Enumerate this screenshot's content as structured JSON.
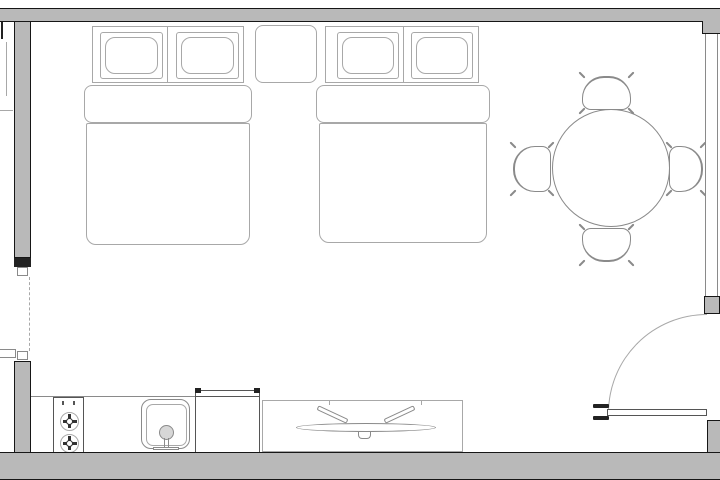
{
  "meta": {
    "title": "studio-room-floor-plan"
  },
  "canvas": {
    "w": 720,
    "h": 480,
    "bg": "#ffffff"
  },
  "colors": {
    "wall_fill": "#b9b9b9",
    "wall_edge": "#161616",
    "mark": "#222222",
    "line_dark": "#555555",
    "line_mid": "#8a8a8a",
    "line_light": "#a8a8a8",
    "fixture": "#d7d7d7",
    "white": "#ffffff"
  },
  "architecture": [
    {
      "name": "top-wall",
      "kind": "wall",
      "box": [
        0,
        8,
        720,
        14
      ],
      "edges": "tb"
    },
    {
      "name": "top-right-corner-wall",
      "kind": "wall",
      "box": [
        702,
        21,
        18,
        13
      ],
      "edges": "lb"
    },
    {
      "name": "left-wall-upper",
      "kind": "wall",
      "box": [
        14,
        21,
        17,
        237
      ],
      "edges": "all"
    },
    {
      "name": "left-wall-end-cap",
      "kind": "block",
      "box": [
        14,
        258,
        17,
        9
      ],
      "color": "mark"
    },
    {
      "name": "left-doorway-jamb-upper",
      "kind": "jamb",
      "box": [
        17,
        267,
        11,
        9
      ]
    },
    {
      "name": "left-doorway-dashed-line",
      "kind": "vdash",
      "box": [
        29,
        277,
        1,
        74
      ]
    },
    {
      "name": "left-doorway-jamb-lower",
      "kind": "jamb",
      "box": [
        17,
        351,
        11,
        9
      ]
    },
    {
      "name": "left-wall-lower",
      "kind": "wall",
      "box": [
        14,
        361,
        17,
        95
      ],
      "edges": "all"
    },
    {
      "name": "right-window",
      "kind": "window",
      "box": [
        705,
        34,
        13,
        262
      ]
    },
    {
      "name": "door-side-pier",
      "kind": "wall",
      "box": [
        704,
        296,
        16,
        18
      ],
      "edges": "all"
    },
    {
      "name": "door-swing-arc",
      "kind": "doorarc",
      "box": [
        608,
        314,
        99,
        99
      ]
    },
    {
      "name": "door-leaf",
      "kind": "doorleaf",
      "box": [
        607,
        409,
        100,
        7
      ]
    },
    {
      "name": "door-handle-mark-upper",
      "kind": "doormark",
      "box": [
        593,
        404,
        16,
        4
      ]
    },
    {
      "name": "door-handle-mark-lower",
      "kind": "doormark",
      "box": [
        593,
        416,
        16,
        4
      ]
    },
    {
      "name": "bottom-right-wall",
      "kind": "wall",
      "box": [
        707,
        420,
        13,
        34
      ],
      "edges": "tl"
    },
    {
      "name": "bottom-wall",
      "kind": "wall",
      "box": [
        0,
        452,
        720,
        28
      ],
      "edges": "tb"
    },
    {
      "name": "adjacent-room-wall-stub",
      "kind": "block",
      "box": [
        1,
        22,
        2,
        17
      ],
      "color": "mark"
    },
    {
      "name": "adjacent-room-fixture-line-v",
      "kind": "vline",
      "box": [
        6,
        42,
        1,
        54
      ],
      "color": "line_light"
    },
    {
      "name": "adjacent-room-fixture-line-h",
      "kind": "hline",
      "box": [
        0,
        110,
        13,
        1
      ],
      "color": "line_light"
    },
    {
      "name": "adjacent-room-shelf",
      "kind": "rect",
      "box": [
        0,
        349,
        16,
        9
      ],
      "edges": "trb",
      "color": "line_mid"
    }
  ],
  "furniture": [
    {
      "name": "bed-1-headboard",
      "kind": "rect",
      "box": [
        92,
        26,
        152,
        57
      ]
    },
    {
      "name": "bed-1-headboard-divider",
      "kind": "vline",
      "box": [
        167,
        26,
        1,
        57
      ],
      "color": "line_light"
    },
    {
      "name": "bed-1-pillow-left",
      "kind": "pillow",
      "box": [
        100,
        32,
        63,
        47
      ]
    },
    {
      "name": "bed-1-pillow-right",
      "kind": "pillow",
      "box": [
        176,
        32,
        63,
        47
      ]
    },
    {
      "name": "bed-1-duvet-fold",
      "kind": "bedband",
      "box": [
        84,
        85,
        168,
        38
      ]
    },
    {
      "name": "bed-1-duvet",
      "kind": "bedbody",
      "box": [
        86,
        123,
        164,
        122
      ]
    },
    {
      "name": "bed-2-headboard",
      "kind": "rect",
      "box": [
        325,
        26,
        154,
        57
      ]
    },
    {
      "name": "bed-2-headboard-divider",
      "kind": "vline",
      "box": [
        403,
        26,
        1,
        57
      ],
      "color": "line_light"
    },
    {
      "name": "bed-2-pillow-left",
      "kind": "pillow",
      "box": [
        337,
        32,
        62,
        47
      ]
    },
    {
      "name": "bed-2-pillow-right",
      "kind": "pillow",
      "box": [
        411,
        32,
        62,
        47
      ]
    },
    {
      "name": "bed-2-duvet-fold",
      "kind": "bedband",
      "box": [
        316,
        85,
        174,
        38
      ]
    },
    {
      "name": "bed-2-duvet",
      "kind": "bedbody",
      "box": [
        319,
        123,
        168,
        120
      ]
    },
    {
      "name": "nightstand",
      "kind": "rect",
      "box": [
        255,
        25,
        62,
        58
      ],
      "r": "8px"
    },
    {
      "name": "dining-table",
      "kind": "circle",
      "box": [
        552,
        109,
        118,
        118
      ]
    },
    {
      "name": "dining-chair-north",
      "kind": "chair",
      "box": [
        580,
        74,
        53,
        38
      ],
      "open": "down"
    },
    {
      "name": "dining-chair-south",
      "kind": "chair",
      "box": [
        580,
        226,
        53,
        38
      ],
      "open": "up"
    },
    {
      "name": "dining-chair-west",
      "kind": "chair",
      "box": [
        511,
        144,
        42,
        50
      ],
      "open": "right"
    },
    {
      "name": "dining-chair-east",
      "kind": "chair",
      "box": [
        667,
        144,
        38,
        50
      ],
      "open": "left"
    },
    {
      "name": "kitchen-counter-edge",
      "kind": "hline",
      "box": [
        31,
        396,
        164,
        1
      ],
      "color": "line_mid"
    },
    {
      "name": "stove",
      "kind": "stove",
      "box": [
        53,
        397,
        31,
        57
      ]
    },
    {
      "name": "kitchen-sink",
      "kind": "sink",
      "box": [
        141,
        399,
        49,
        50
      ]
    },
    {
      "name": "refrigerator",
      "kind": "fridge",
      "box": [
        195,
        390,
        65,
        65
      ]
    },
    {
      "name": "tv-console",
      "kind": "console",
      "box": [
        262,
        400,
        201,
        52
      ]
    },
    {
      "name": "tv",
      "kind": "tv",
      "box": [
        296,
        408,
        140,
        32
      ]
    }
  ]
}
